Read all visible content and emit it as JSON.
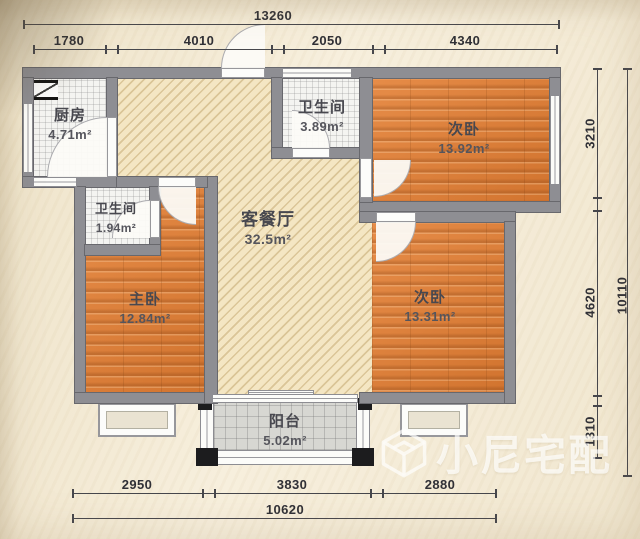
{
  "fp": {
    "rooms": [
      {
        "name": "厨房",
        "area": "4.71m²"
      },
      {
        "name": "卫生间",
        "area": "3.89m²"
      },
      {
        "name": "次卧",
        "area": "13.92m²"
      },
      {
        "name": "卫生间",
        "area": "1.94m²"
      },
      {
        "name": "客餐厅",
        "area": "32.5m²"
      },
      {
        "name": "主卧",
        "area": "12.84m²"
      },
      {
        "name": "次卧",
        "area": "13.31m²"
      },
      {
        "name": "阳台",
        "area": "5.02m²"
      }
    ],
    "dims": {
      "top_total": "13260",
      "top": [
        "1780",
        "4010",
        "2050",
        "4340"
      ],
      "right": [
        "3210",
        "4620",
        "1310"
      ],
      "right_total": "10110",
      "bottom": [
        "2950",
        "3830",
        "2880"
      ],
      "bottom_total": "10620"
    },
    "watermark": "小尼宅配",
    "colors": {
      "wall": "#8e8e93",
      "wood": "#dd8140",
      "hatch": "#f4e6c3",
      "paper": "#f4ebd6",
      "accent_black": "#1c1c1e"
    }
  }
}
